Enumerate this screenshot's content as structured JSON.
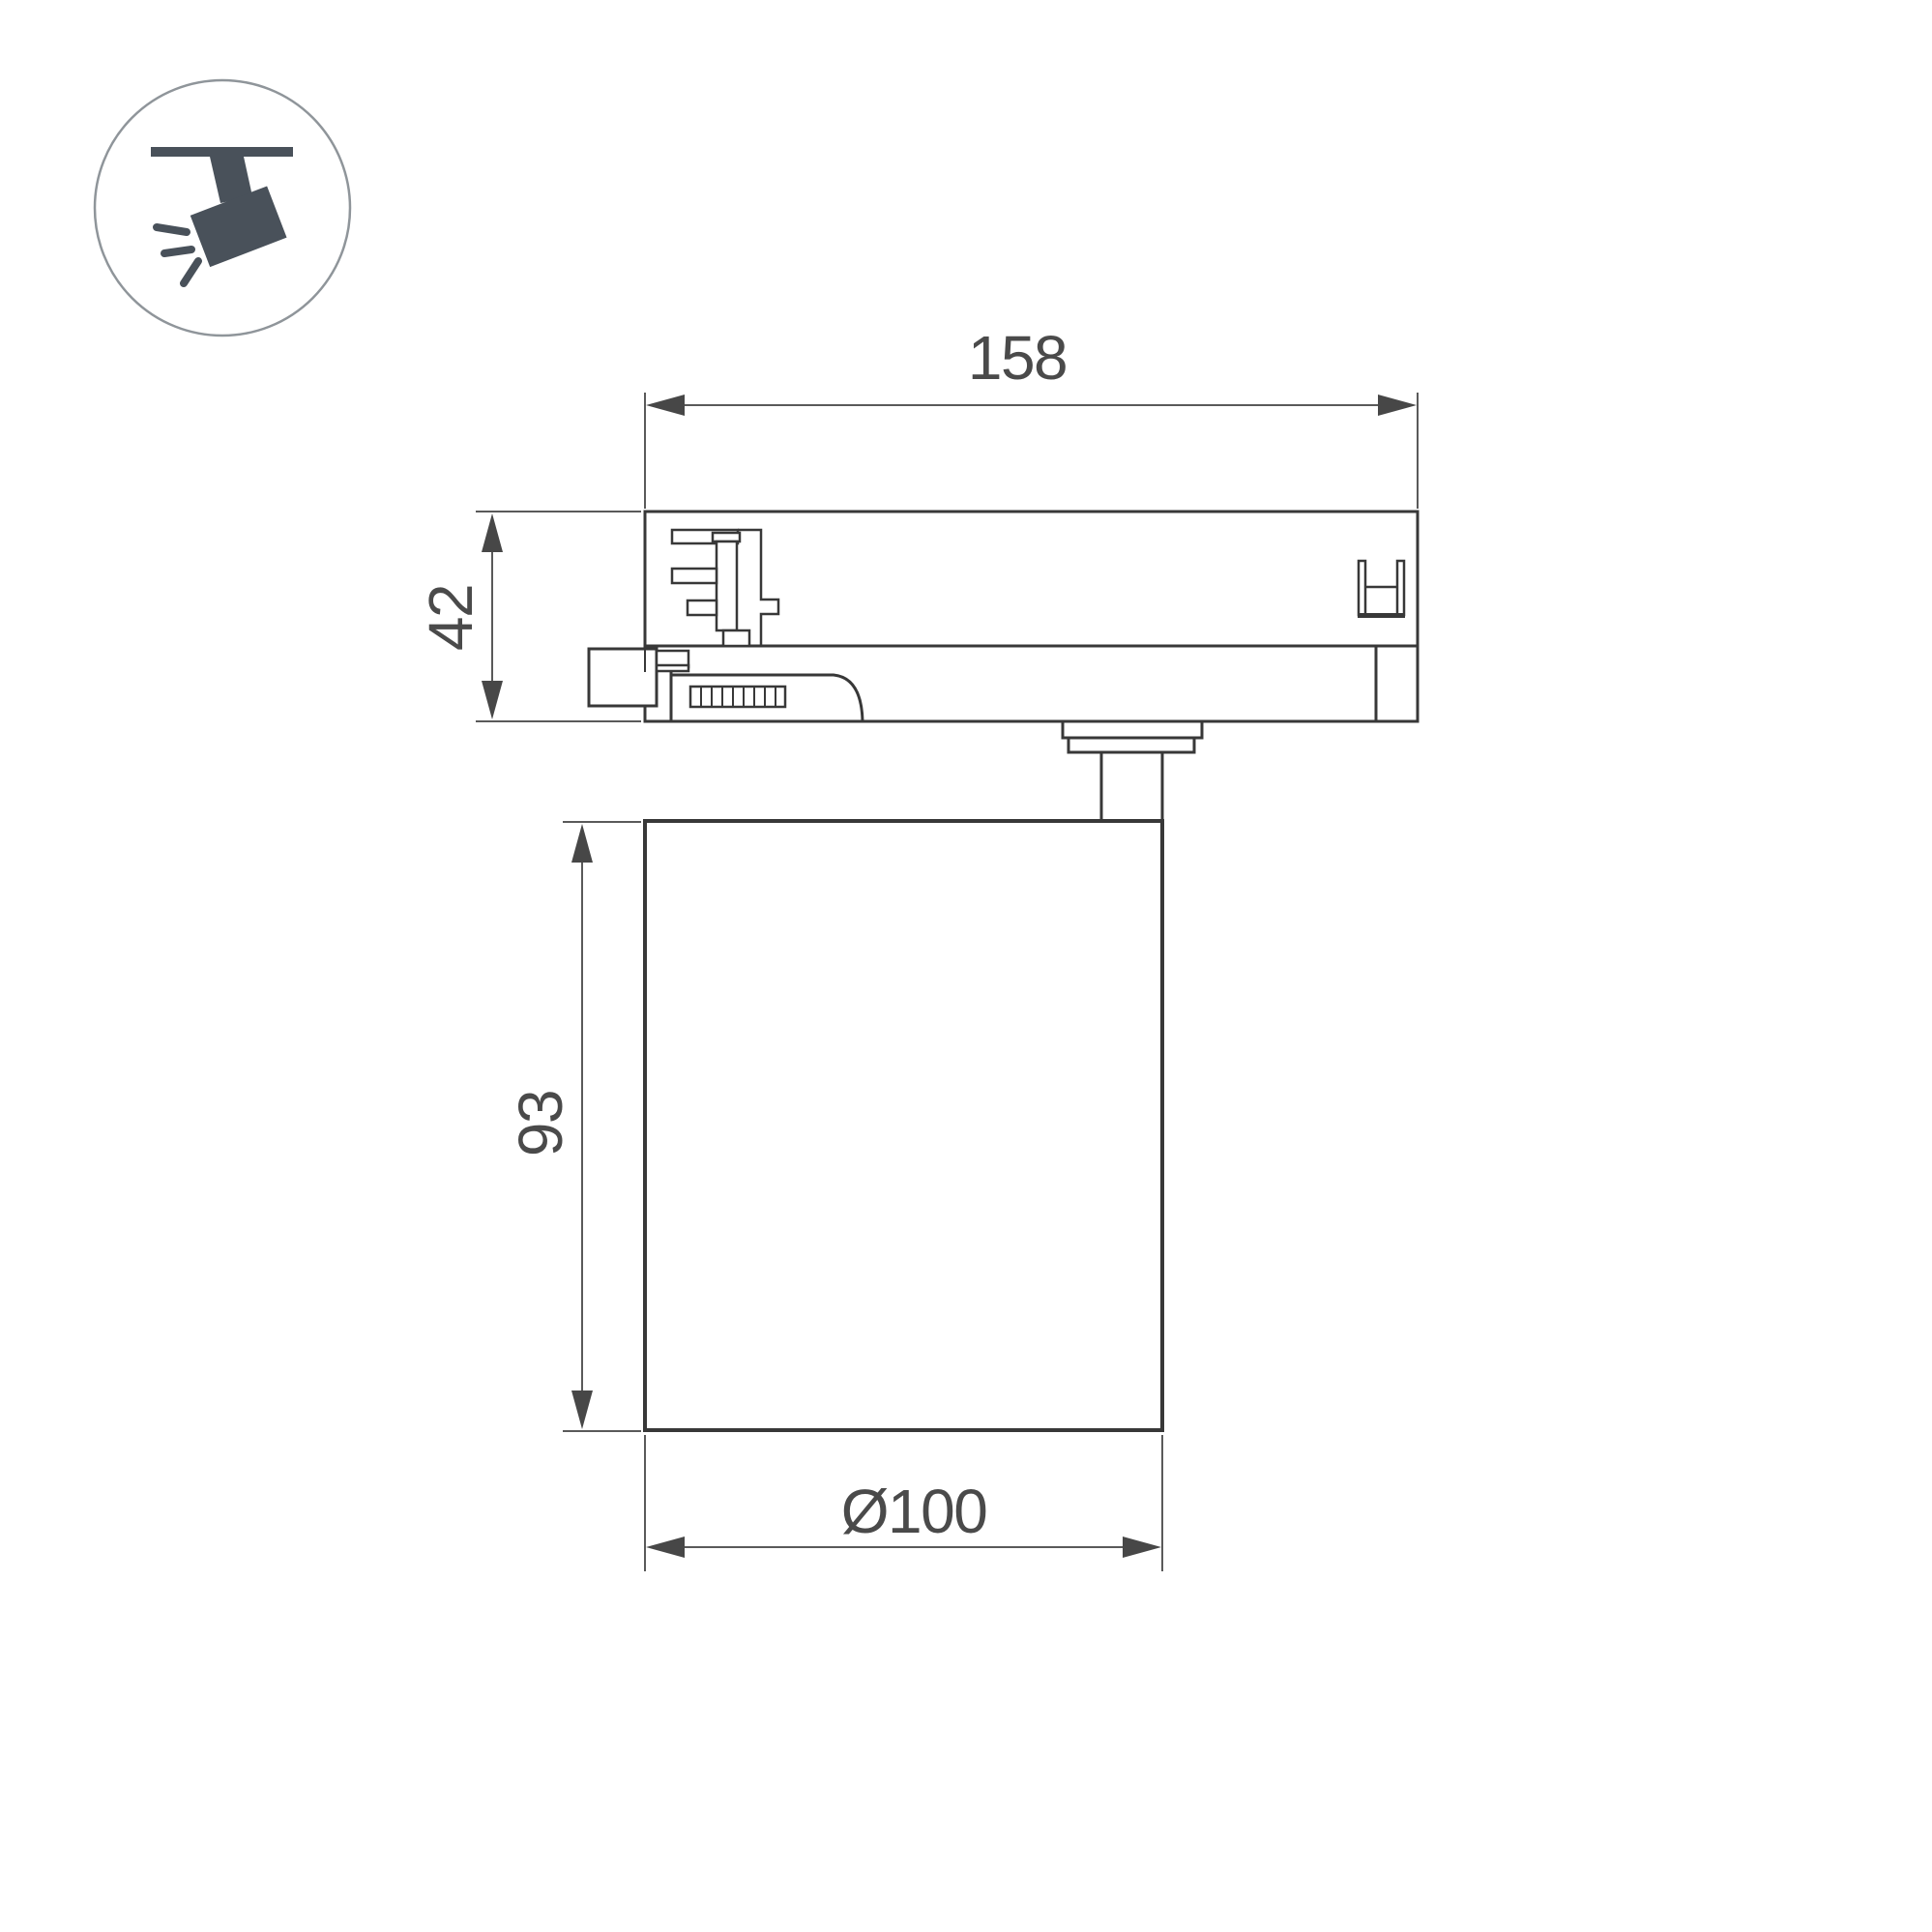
{
  "page": {
    "background": "#ffffff",
    "description": "Technical dimensional drawing of a track-mounted spotlight luminaire"
  },
  "icon": {
    "name": "track-spotlight-pictogram",
    "glyph_color": "#49515a",
    "circle_stroke": "#8f959a"
  },
  "drawing": {
    "object_line_color": "#383838",
    "dimension_line_color": "#5a5a5a",
    "text_color": "#4a4a4a",
    "dimensions": {
      "adapter_width": "158",
      "adapter_height": "42",
      "body_height": "93",
      "body_diameter": "Ø100"
    }
  }
}
